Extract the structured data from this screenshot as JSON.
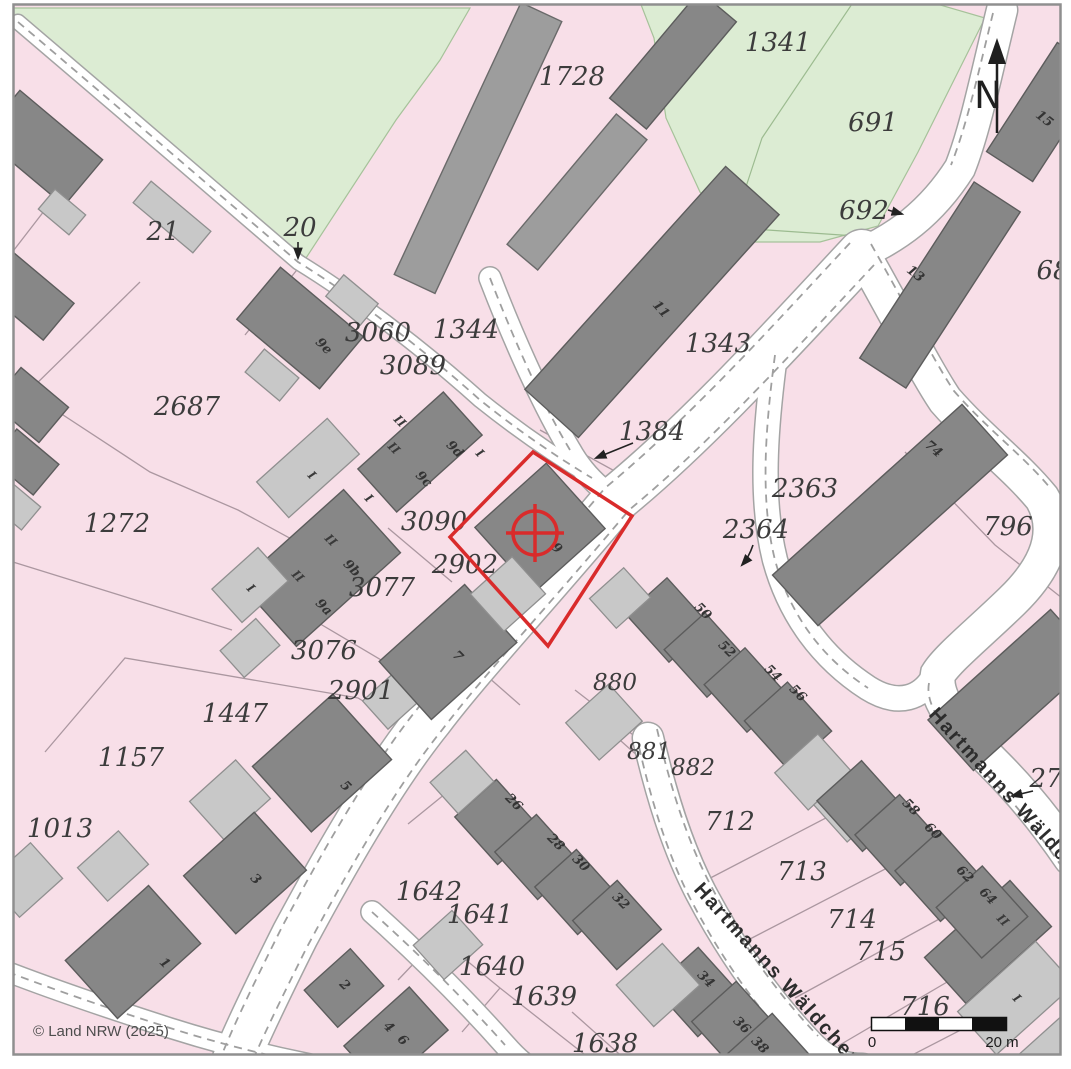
{
  "map": {
    "copyright": "© Land NRW (2025)",
    "north_label": "N",
    "scale_bar": {
      "zero_label": "0",
      "end_label": "20 m"
    },
    "street_name": "Hartmanns Wäldchen",
    "marker": "target-crosshair-icon",
    "colors": {
      "parcel_fill": "#f8dfe8",
      "green_fill": "#dcecd3",
      "building_dark": "#878787",
      "building_light": "#c8c8c8",
      "street_fill": "#ffffff",
      "highlight_red": "#d92b2b",
      "parcel_line": "#ab97a0"
    }
  },
  "parcels": {
    "n21": "21",
    "n20": "20",
    "n1728": "1728",
    "n1341": "1341",
    "n691": "691",
    "n692": "692",
    "n68": "68",
    "n2687": "2687",
    "n3060": "3060",
    "n1344": "1344",
    "n3089": "3089",
    "n1343": "1343",
    "n1384": "1384",
    "n1272": "1272",
    "n3090": "3090",
    "n2902": "2902",
    "n3077": "3077",
    "n3076": "3076",
    "n2901": "2901",
    "n1447": "1447",
    "n1157": "1157",
    "n1013": "1013",
    "n2363": "2363",
    "n2364": "2364",
    "n796": "796",
    "n880": "880",
    "n881": "881",
    "n882": "882",
    "n712": "712",
    "n713": "713",
    "n714": "714",
    "n715": "715",
    "n716": "716",
    "n27": "27",
    "n1642": "1642",
    "n1641": "1641",
    "n1640": "1640",
    "n1639": "1639",
    "n1638": "1638"
  },
  "houses": {
    "h1": "1",
    "h2": "2",
    "h3": "3",
    "h4": "4",
    "h5": "5",
    "h6": "6",
    "h7": "7",
    "h9": "9",
    "h9a": "9a",
    "h9b": "9b",
    "h9c": "9c",
    "h9d": "9d",
    "h9e": "9e",
    "h11": "11",
    "h13": "13",
    "h15": "15",
    "h26": "26",
    "h28": "28",
    "h30": "30",
    "h32": "32",
    "h34": "34",
    "h36": "36",
    "h38": "38",
    "h50": "50",
    "h52": "52",
    "h54": "54",
    "h56": "56",
    "h58": "58",
    "h60": "60",
    "h62": "62",
    "h64": "64",
    "h74": "74"
  },
  "storeys": {
    "r1": "I",
    "r2": "II"
  }
}
